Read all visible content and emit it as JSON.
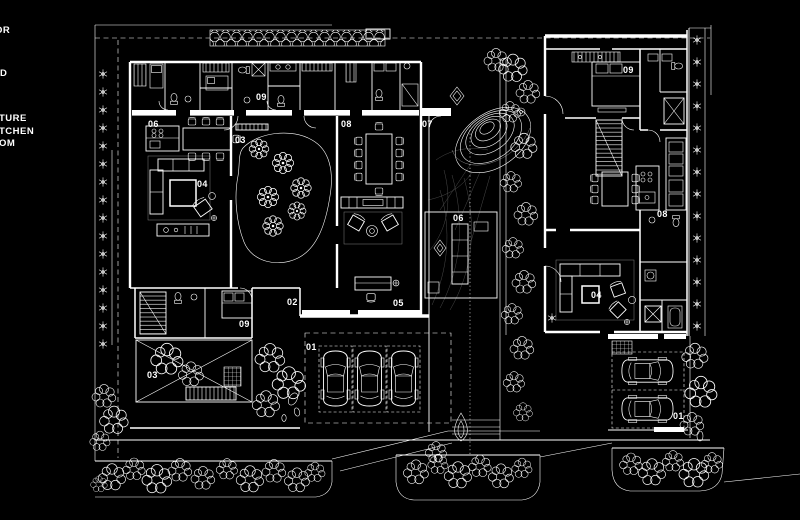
{
  "canvas": {
    "width": 800,
    "height": 520,
    "background": "#000000",
    "linework_color": "#ffffff"
  },
  "legend": {
    "fragments": [
      {
        "text": "OR",
        "x": -5,
        "y": 33
      },
      {
        "text": "D",
        "x": 0,
        "y": 76
      },
      {
        "text": "TURE",
        "x": -1,
        "y": 121
      },
      {
        "text": "TCHEN",
        "x": -1,
        "y": 134
      },
      {
        "text": "OM",
        "x": -1,
        "y": 146
      }
    ]
  },
  "room_labels": [
    {
      "text": "09",
      "x": 256,
      "y": 100
    },
    {
      "text": "06",
      "x": 148,
      "y": 127
    },
    {
      "text": "03",
      "x": 235,
      "y": 143
    },
    {
      "text": "04",
      "x": 197,
      "y": 187
    },
    {
      "text": "08",
      "x": 341,
      "y": 127
    },
    {
      "text": "07",
      "x": 422,
      "y": 127
    },
    {
      "text": "06",
      "x": 453,
      "y": 221
    },
    {
      "text": "02",
      "x": 287,
      "y": 305
    },
    {
      "text": "05",
      "x": 393,
      "y": 306
    },
    {
      "text": "09",
      "x": 239,
      "y": 327
    },
    {
      "text": "03",
      "x": 147,
      "y": 378
    },
    {
      "text": "01",
      "x": 306,
      "y": 350
    },
    {
      "text": "09",
      "x": 623,
      "y": 73
    },
    {
      "text": "08",
      "x": 657,
      "y": 217
    },
    {
      "text": "04",
      "x": 591,
      "y": 298
    },
    {
      "text": "01",
      "x": 673,
      "y": 419
    }
  ]
}
